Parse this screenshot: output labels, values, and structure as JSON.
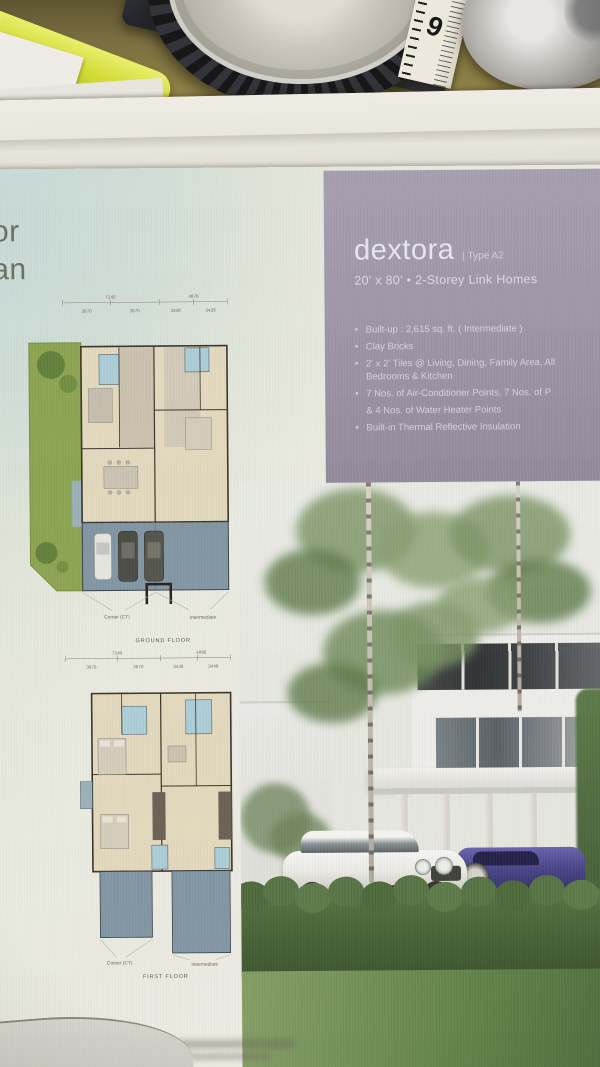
{
  "brochure": {
    "partial_heading": {
      "line1": "or",
      "line2": "an"
    },
    "info_panel": {
      "title": "dextora",
      "type_label": "| Type A2",
      "subtitle": "20' x 80' • 2-Storey Link Homes",
      "features": [
        {
          "marker": "•",
          "text": "Built-up : 2,615 sq. ft. ( Intermediate )"
        },
        {
          "marker": "•",
          "text": "Clay Bricks"
        },
        {
          "marker": "•",
          "text": "2' x 2' Tiles @ Living, Dining, Family Area, All Bedrooms & Kitchen"
        },
        {
          "marker": "•",
          "text": "7 Nos. of Air-Conditioner Points, 7 Nos. of P"
        },
        {
          "marker": "",
          "text": "& 4 Nos. of Water Heater Points"
        },
        {
          "marker": "•",
          "text": "Built-in Thermal Reflective Insulation"
        }
      ]
    },
    "ground_floor": {
      "name": "GROUND FLOOR",
      "unit_left": "Corner (CT)",
      "unit_right": "Intermediate",
      "dims": {
        "overall_left": "7140",
        "overall_right": "4876",
        "seg1": "3670",
        "seg2": "3670",
        "seg3": "3438",
        "seg4": "3438"
      }
    },
    "first_floor": {
      "name": "FIRST FLOOR",
      "unit_left": "Corner (CT)",
      "unit_right": "Intermediate",
      "dims": {
        "overall_left": "7140",
        "overall_right": "4896",
        "seg1": "3670",
        "seg2": "3670",
        "seg3": "3448",
        "seg4": "3448"
      }
    }
  },
  "measuring_tape": {
    "digit": "9"
  },
  "colors": {
    "panel_purple": "#a29aae",
    "page_tint": "#cfe2e2",
    "plan_floor": "#e8dec2",
    "plan_bath": "#aed3de",
    "plan_driveway": "#8399a9",
    "plan_garden": "#8fa851",
    "hedge_green": "#4e6b3a",
    "desk_olive": "#968747",
    "highlighter_yellow": "#d7e232"
  }
}
